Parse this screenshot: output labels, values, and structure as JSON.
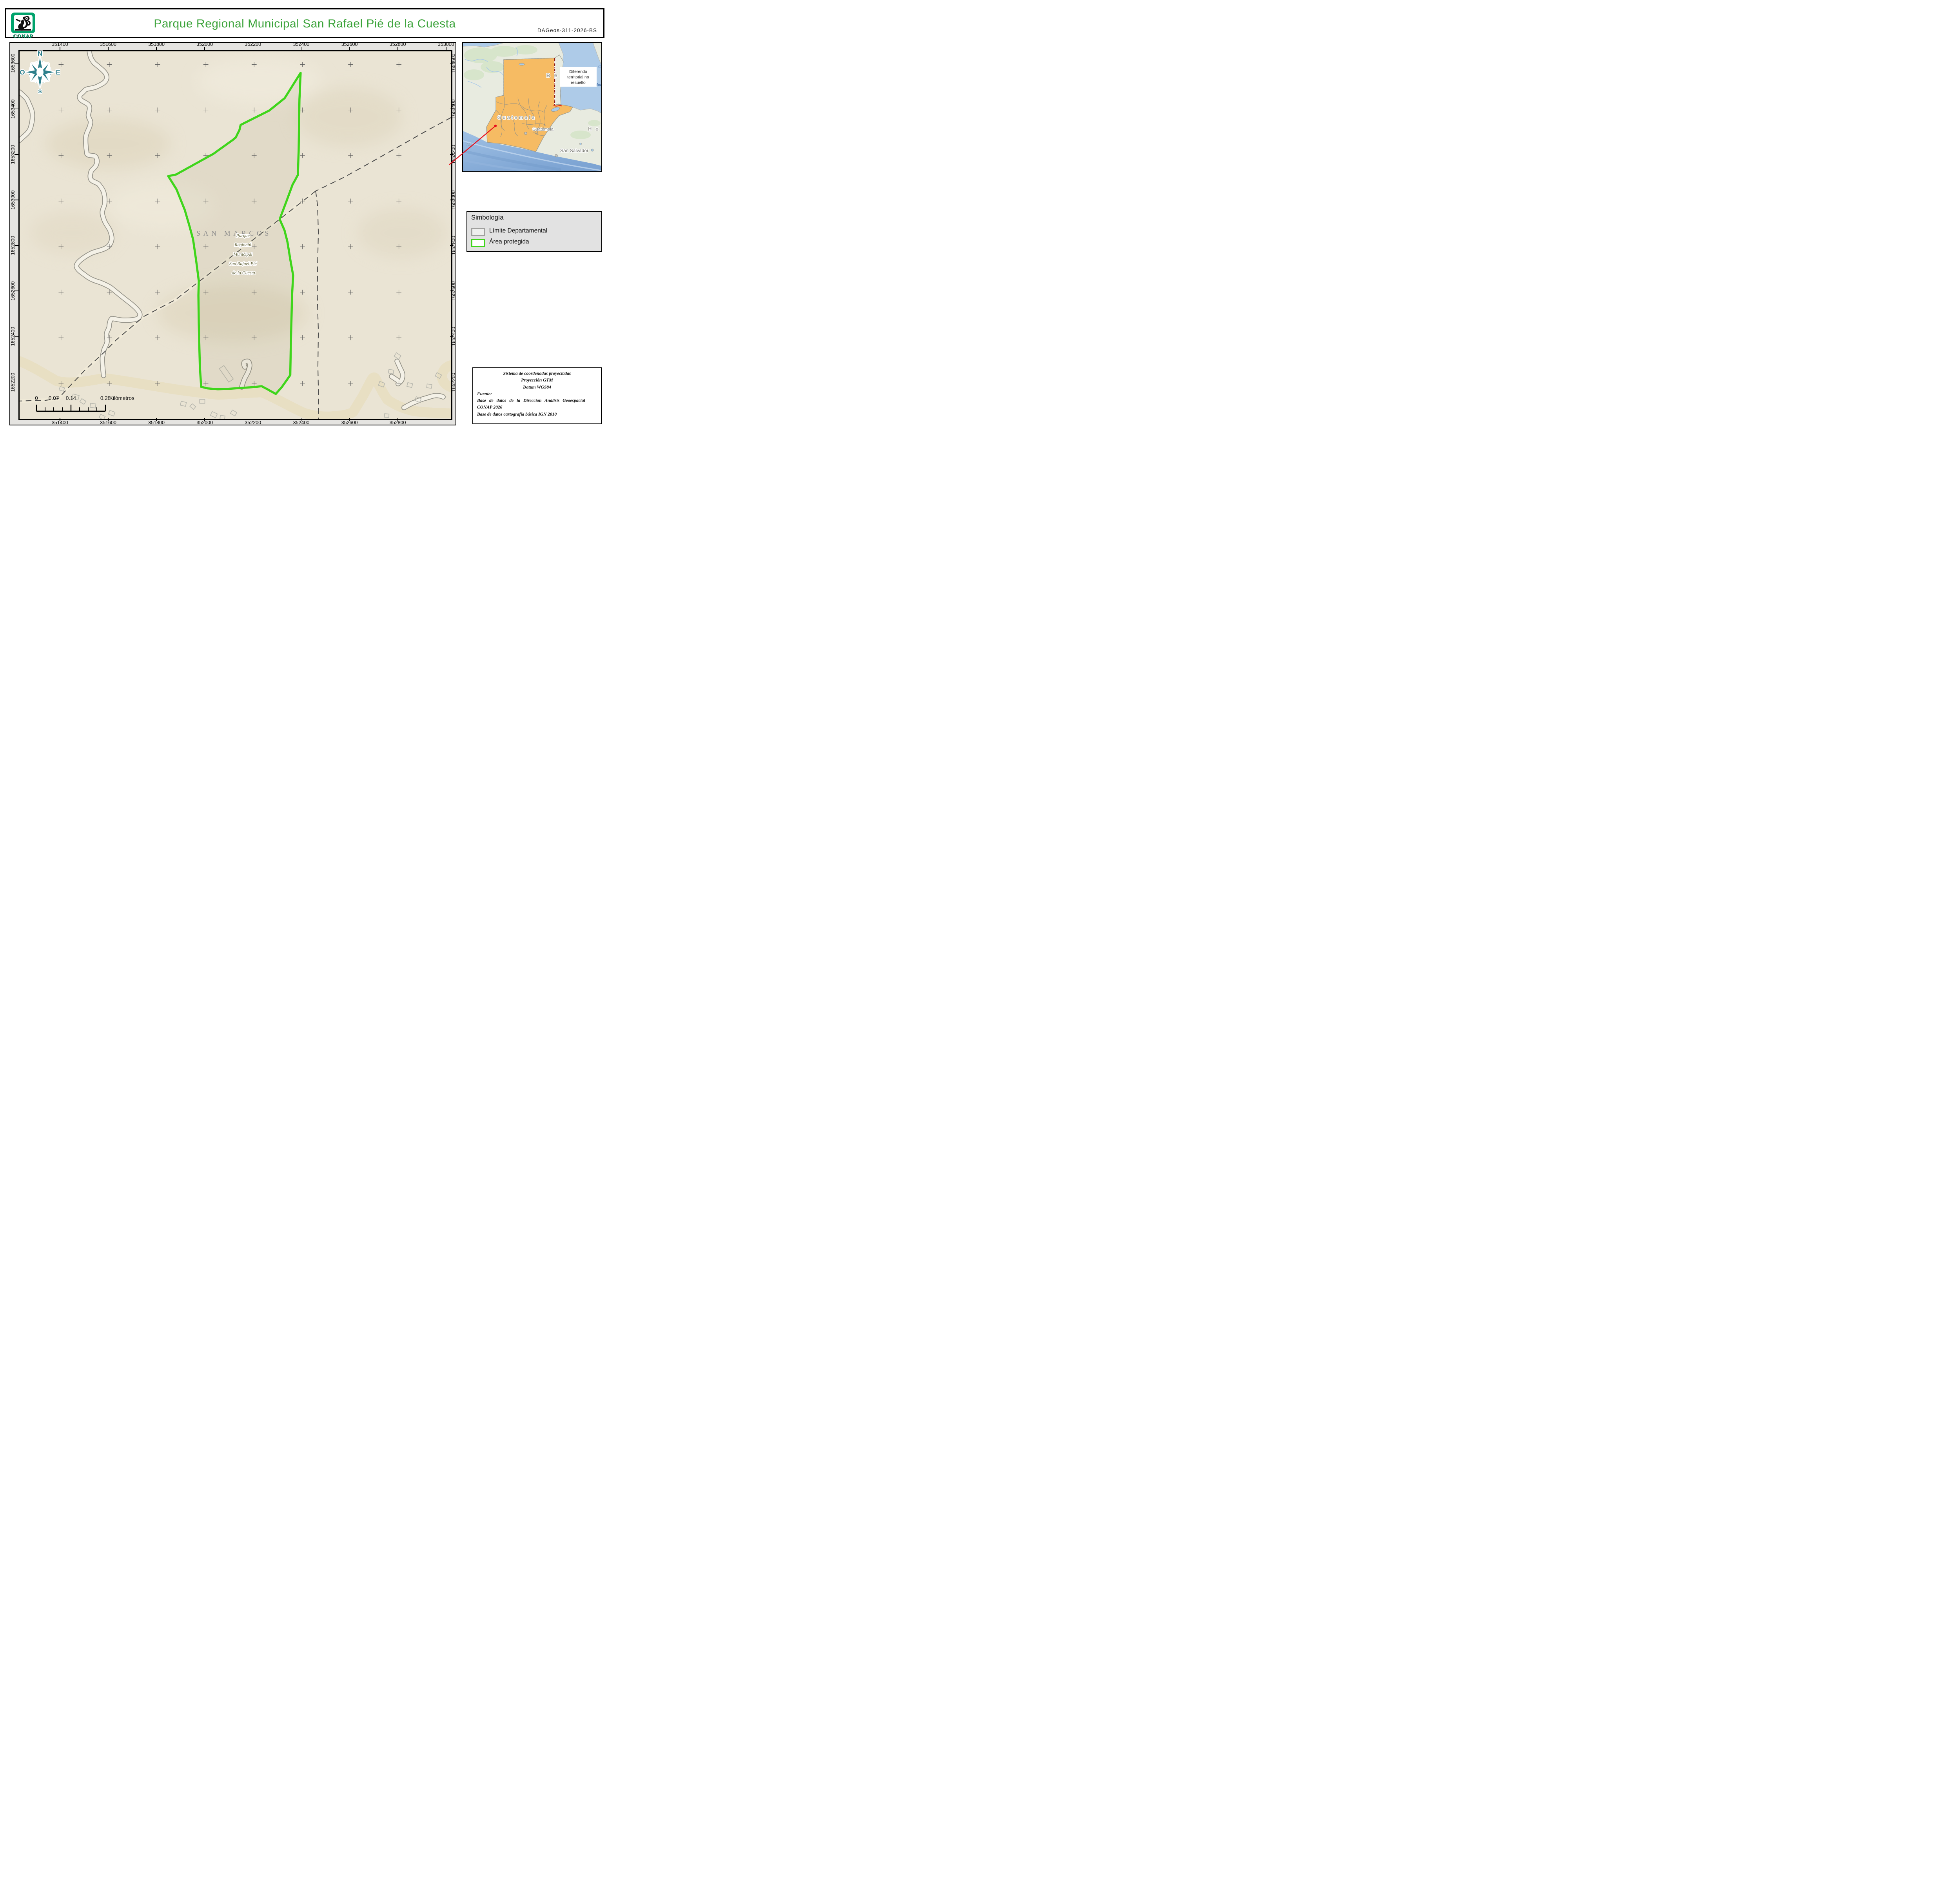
{
  "header": {
    "logo_text": "CONAP",
    "title": "Parque Regional Municipal San Rafael Pié de la Cuesta",
    "doc_id": "DAGeos-311-2026-BS"
  },
  "compass": {
    "n": "N",
    "e": "E",
    "s": "S",
    "o": "O"
  },
  "map": {
    "x_ticks": [
      {
        "label": "351400",
        "f": 0.0961
      },
      {
        "label": "351600",
        "f": 0.208
      },
      {
        "label": "351800",
        "f": 0.3198
      },
      {
        "label": "352000",
        "f": 0.4316
      },
      {
        "label": "352200",
        "f": 0.5434
      },
      {
        "label": "352400",
        "f": 0.6553
      },
      {
        "label": "352600",
        "f": 0.7671
      },
      {
        "label": "352800",
        "f": 0.8789
      },
      {
        "label": "353000",
        "f": 0.9907
      }
    ],
    "y_ticks": [
      {
        "label": "1653600",
        "f": 0.0357
      },
      {
        "label": "1653400",
        "f": 0.1597
      },
      {
        "label": "1653200",
        "f": 0.2836
      },
      {
        "label": "1653000",
        "f": 0.4076
      },
      {
        "label": "1652800",
        "f": 0.5316
      },
      {
        "label": "1652600",
        "f": 0.6555
      },
      {
        "label": "1652400",
        "f": 0.7795
      },
      {
        "label": "1652200",
        "f": 0.9035
      }
    ],
    "department_label": "SAN MARCOS",
    "park_label_lines": [
      "Parque",
      "Regional",
      "Municipal",
      "San Rafael Pié",
      "de la Cuesta"
    ]
  },
  "scalebar": {
    "labels": [
      {
        "text": "0",
        "f": 0
      },
      {
        "text": "0.07",
        "f": 0.25
      },
      {
        "text": "0.14",
        "f": 0.5
      },
      {
        "text": "0.28",
        "f": 1
      }
    ],
    "unit": "Kilómetros"
  },
  "legend": {
    "title": "Simbología",
    "items": [
      {
        "label": "Límite Departamental"
      },
      {
        "label": "Área protegida"
      }
    ]
  },
  "inset": {
    "country_label": "G u a t e m a l a",
    "city_guatemala": "Guatemala",
    "city_san_salvador": "San Salvador",
    "partial_honduras": "H o",
    "partial_belize": "B e",
    "water_label_1": "Gu",
    "water_label_2": "Hond",
    "road_number": "721",
    "note_line1": "Diferendo",
    "note_line2": "territorial no",
    "note_line3": "resuelto"
  },
  "credits": {
    "line1": "Sistema de coordenadas proyectadas",
    "line2": "Proyección GTM",
    "line3": "Datum WGS84",
    "line4": "Fuente:",
    "line5": "Base de datos de la Dirección Análisis Geoespacial",
    "line6": "CONAP 2026",
    "line7": "Base de datos cartografía básica IGN 2010"
  },
  "colors": {
    "title_green": "#3ba33a",
    "conap_green": "#00a36c",
    "protected_area_green": "#3fd51b",
    "boundary_gray": "#4c4c4c",
    "map_background": "#eae4d4",
    "road_tan": "#e8dfc3",
    "guatemala_orange": "#f6bb63",
    "ocean_blue": "#aecbe8",
    "red_leader": "#e8101c",
    "dispute_dark_red": "#8e1a12"
  }
}
